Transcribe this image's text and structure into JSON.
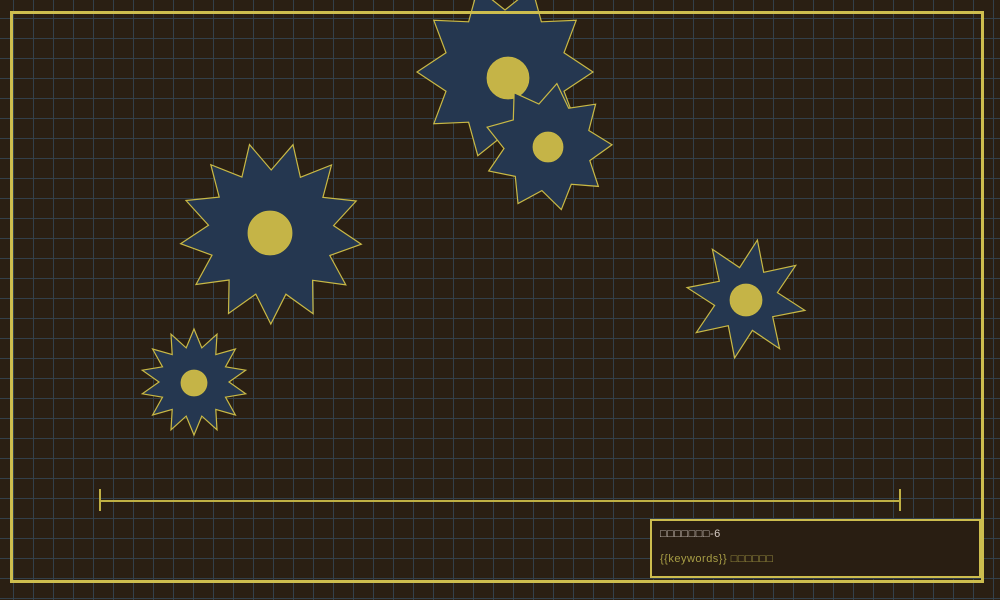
{
  "scene": {
    "background_color": "#2a1f13",
    "grid_color": "#33404a",
    "grid_size": 20,
    "frame_color": "#cdbd4e",
    "gear_fill": "#253750",
    "gear_stroke": "#c9b945",
    "gear_core_color": "#c5b447",
    "track_color": "#bfb044"
  },
  "gears": [
    {
      "cx": 505,
      "cy": 72,
      "outer_radius": 88,
      "inner_radius": 62,
      "points": 10,
      "rotation": 18,
      "core_cx": 508,
      "core_cy": 78,
      "core_radius": 21
    },
    {
      "cx": 548,
      "cy": 147,
      "outer_radius": 64,
      "inner_radius": 44,
      "points": 9,
      "rotation": 8,
      "core_cx": 548,
      "core_cy": 147,
      "core_radius": 15
    },
    {
      "cx": 271,
      "cy": 233,
      "outer_radius": 91,
      "inner_radius": 63,
      "points": 13,
      "rotation": 14,
      "core_cx": 270,
      "core_cy": 233,
      "core_radius": 22
    },
    {
      "cx": 194,
      "cy": 382,
      "outer_radius": 53,
      "inner_radius": 35,
      "points": 14,
      "rotation": 0,
      "core_cx": 194,
      "core_cy": 383,
      "core_radius": 13
    },
    {
      "cx": 746,
      "cy": 299,
      "outer_radius": 60,
      "inner_radius": 32,
      "points": 8,
      "rotation": 11,
      "core_cx": 746,
      "core_cy": 300,
      "core_radius": 16
    }
  ],
  "track": {
    "x": 100,
    "y": 500,
    "width": 800,
    "tick_height": 22
  },
  "info_box": {
    "line1": "□□□□□□□-6",
    "line1_color": "#d6ccc4",
    "line2": "{{keywords}} □□□□□□",
    "line2_color": "#a89e45"
  }
}
